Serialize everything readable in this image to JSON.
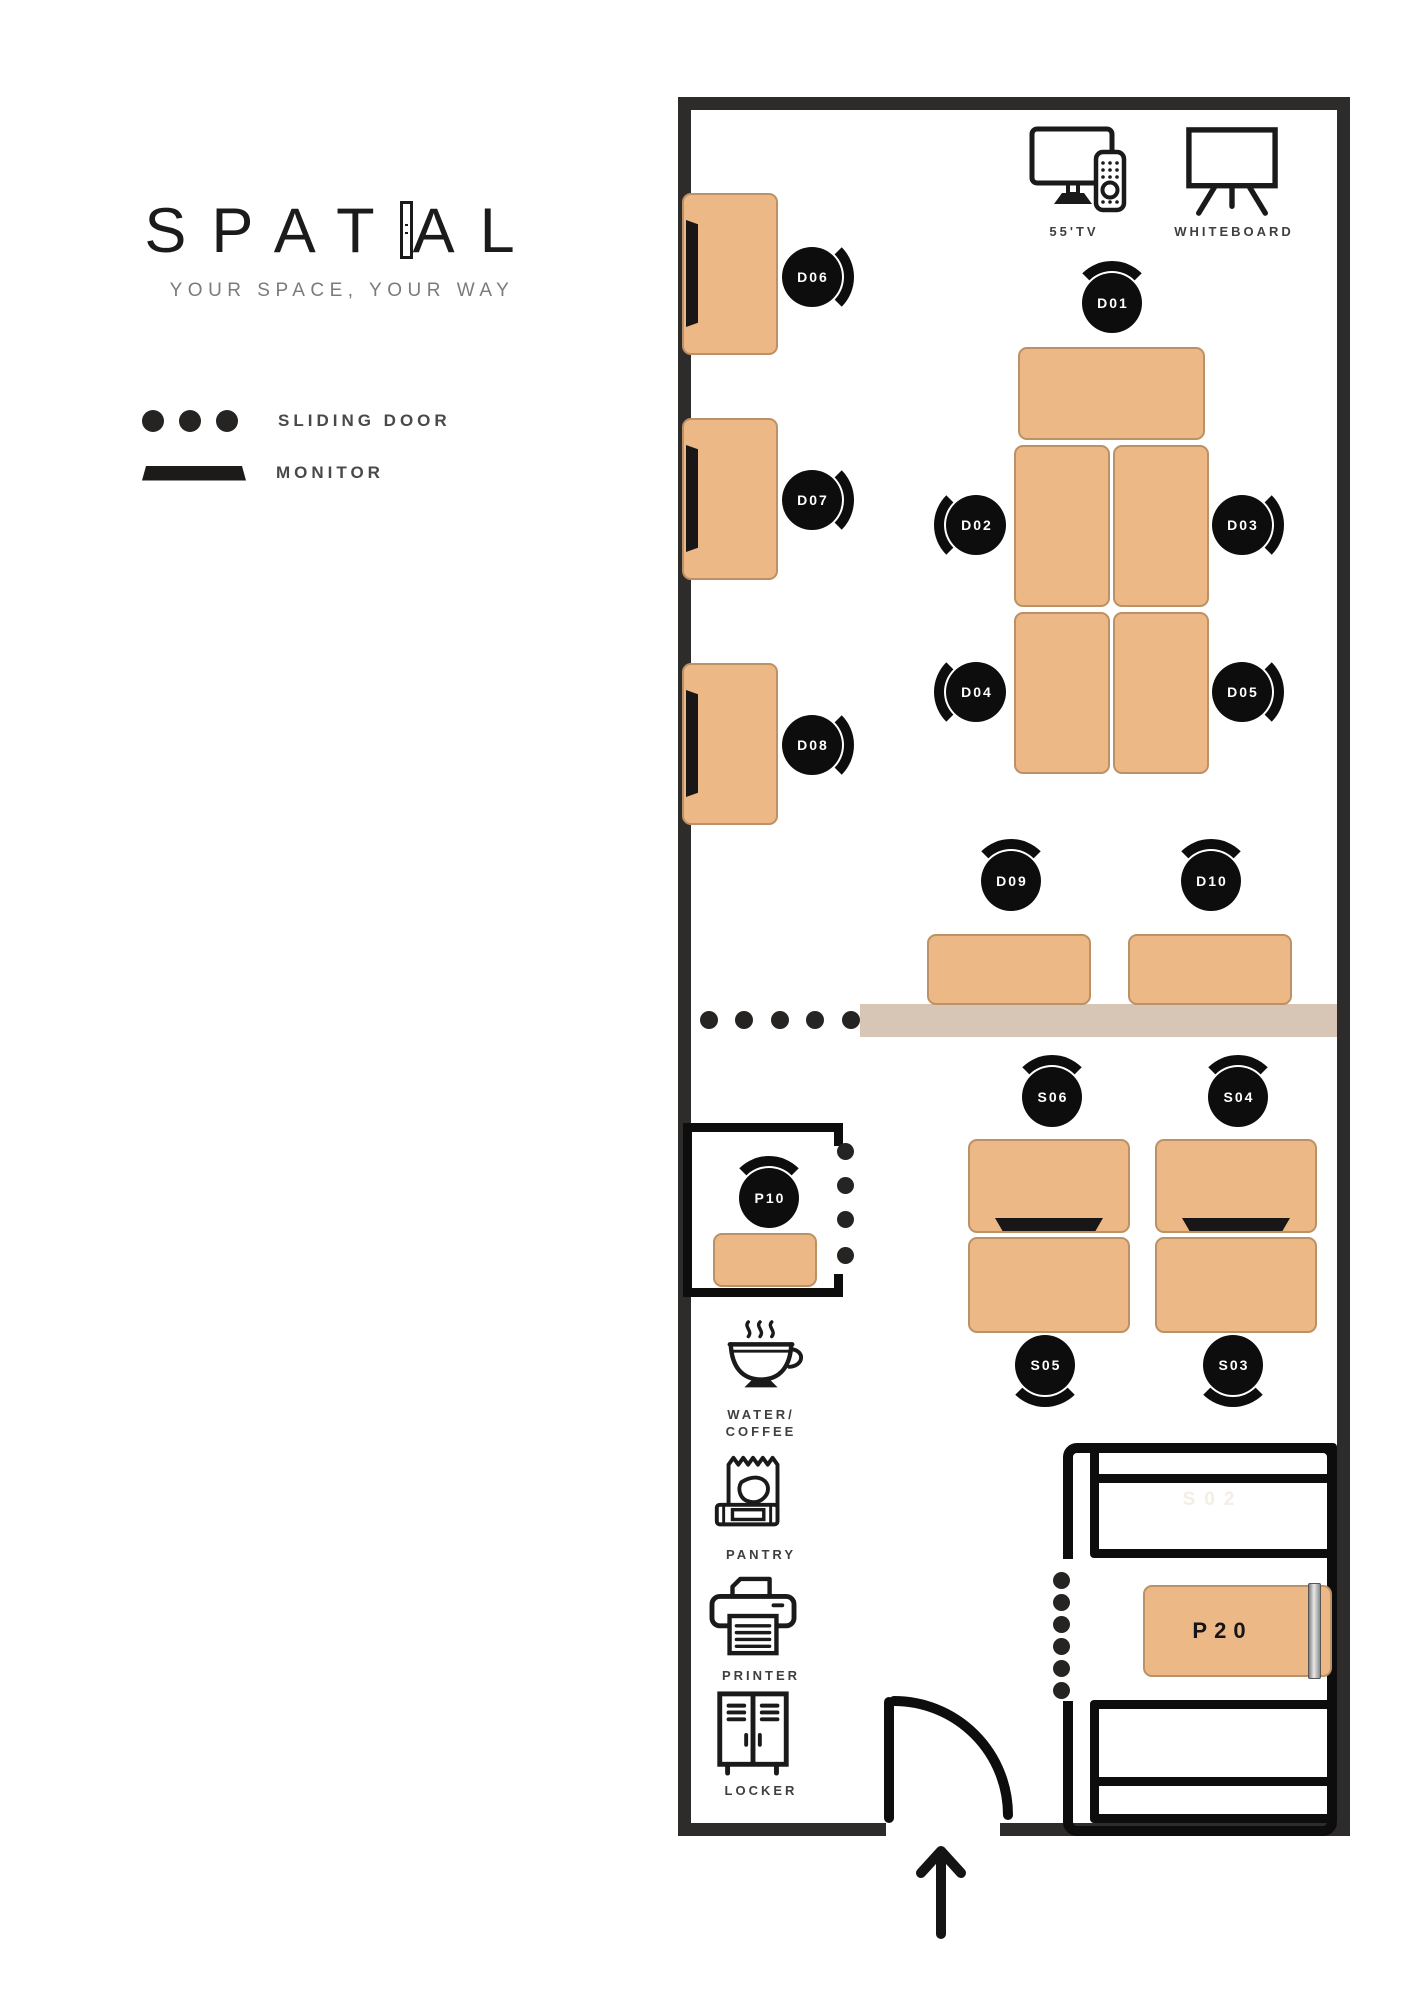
{
  "logo": {
    "part1": "SPAT",
    "part2": "AL",
    "full": "SPATIAL",
    "tagline": "YOUR SPACE, YOUR WAY"
  },
  "legend": {
    "sliding_door": "SLIDING DOOR",
    "monitor": "MONITOR"
  },
  "equipment": {
    "tv": "55'TV",
    "whiteboard": "WHITEBOARD"
  },
  "amenities": {
    "water1": "WATER/",
    "water2": "COFFEE",
    "pantry": "PANTRY",
    "printer": "PRINTER",
    "locker": "LOCKER"
  },
  "seats": {
    "d01": "D01",
    "d02": "D02",
    "d03": "D03",
    "d04": "D04",
    "d05": "D05",
    "d06": "D06",
    "d07": "D07",
    "d08": "D08",
    "d09": "D09",
    "d10": "D10",
    "s02": "S02",
    "s03": "S03",
    "s04": "S04",
    "s05": "S05",
    "s06": "S06",
    "p10": "P10",
    "p20": "P20"
  },
  "colors": {
    "desk": "#ECB885",
    "desk_border": "#BB9165",
    "wall": "#2E2B2B",
    "ink": "#0D0D0D",
    "divider": "#D7C5B6",
    "faint_room_label": "#F4EEE3",
    "legend_text": "#4B4848"
  }
}
